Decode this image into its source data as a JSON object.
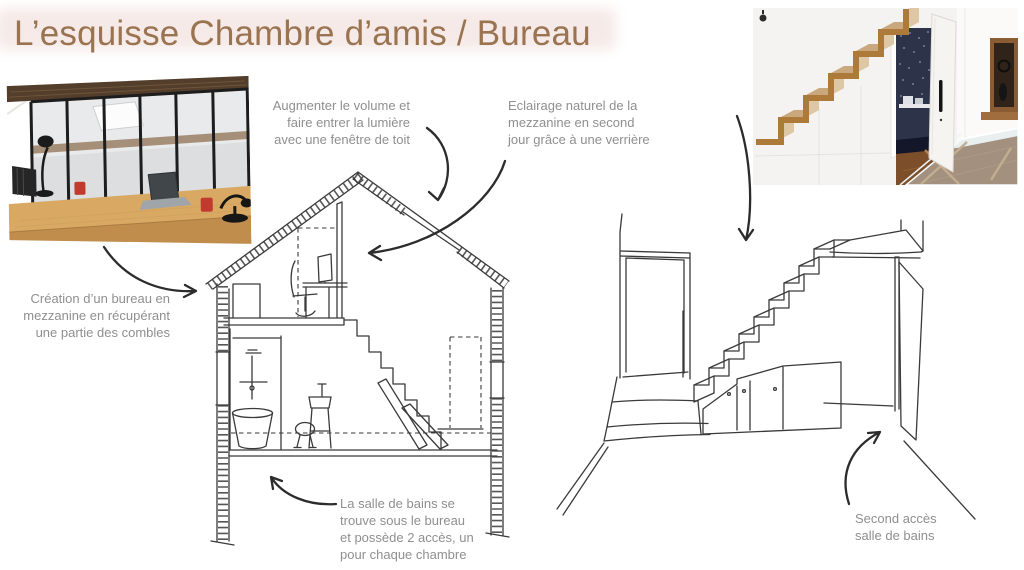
{
  "slide": {
    "title": "L’esquisse Chambre d’amis / Bureau",
    "colors": {
      "title_text": "#9a7350",
      "title_highlight": "#f5eae7",
      "annotation_text": "#8f8f8f",
      "sketch_ink": "#3a3a3a",
      "copper_stairs": "#ad7a3a",
      "desk_wood": "#d9a963"
    }
  },
  "annotations": {
    "roof_window": {
      "text": "Augmenter le volume et\nfaire entrer la lumière\navec une fenêtre de toit"
    },
    "natural_light": {
      "text": "Eclairage naturel de la\nmezzanine en second\njour grâce à une verrière"
    },
    "mezzanine_office": {
      "text": "Création d’un bureau en\nmezzanine en récupérant\nune partie des combles"
    },
    "bathroom": {
      "text": "La salle de bains se\ntrouve sous le bureau\net possède 2 accès, un\npour chaque chambre"
    },
    "second_access": {
      "text": "Second accès\nsalle de bains"
    }
  }
}
